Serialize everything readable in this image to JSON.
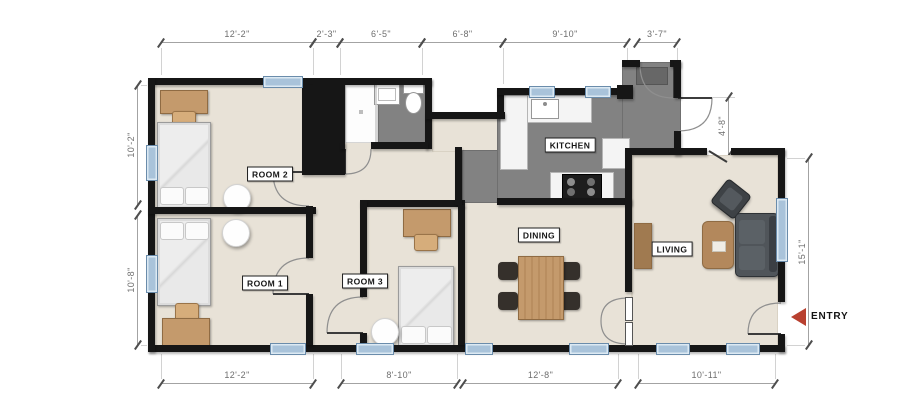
{
  "rooms": {
    "room1": "ROOM 1",
    "room2": "ROOM 2",
    "room3": "ROOM 3",
    "kitchen": "KITCHEN",
    "dining": "DINING",
    "living": "LIVING"
  },
  "entry": {
    "label": "ENTRY"
  },
  "dimensions": {
    "top": [
      "12'-2\"",
      "2'-3\"",
      "6'-5\"",
      "6'-8\"",
      "9'-10\"",
      "3'-7\""
    ],
    "bottom": [
      "12'-2\"",
      "8'-10\"",
      "12'-8\"",
      "10'-11\""
    ],
    "left": [
      "10'-2\"",
      "10'-8\""
    ],
    "right": [
      "4'-8\"",
      "15'-1\""
    ]
  },
  "colors": {
    "wall": "#161616",
    "floor": "#e8e2d7",
    "tile_floor": "#828282",
    "window": "#a9c3da",
    "wood": "#c49a6c",
    "entry_arrow": "#b8402f"
  }
}
